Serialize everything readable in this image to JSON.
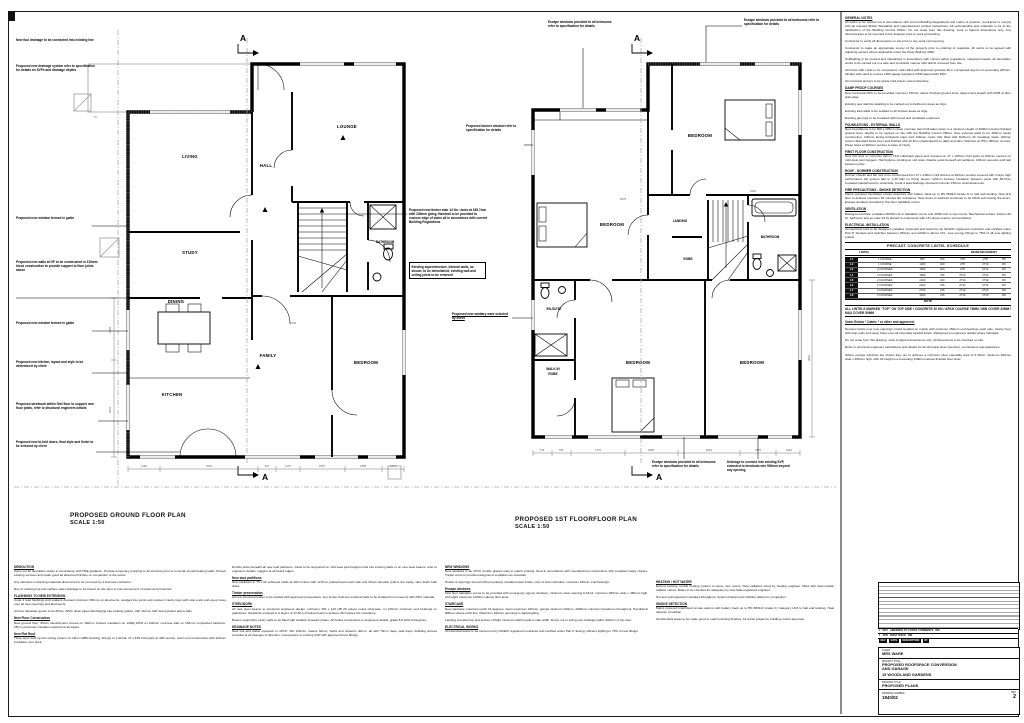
{
  "ground_plan": {
    "title": "PROPOSED GROUND FLOOR PLAN",
    "scale": "SCALE 1:50",
    "section_letter": "A",
    "grid_label": "B1",
    "rooms": {
      "living": "LIVING",
      "hall": "HALL",
      "lounge": "LOUNGE",
      "study": "STUDY",
      "bathroom": "BATHROOM",
      "dining": "DINING",
      "family": "FAMILY",
      "kitchen": "KITCHEN",
      "bedroom": "BEDROOM"
    },
    "dims_bottom": [
      "1190",
      "7016",
      "917",
      "1170",
      "1875",
      "1485",
      "1774"
    ],
    "dims_left": [
      "1884",
      "3001"
    ],
    "dims_inner": [
      "6703"
    ]
  },
  "first_plan": {
    "title": "PROPOSED 1ST FLOORFLOOR PLAN",
    "scale": "SCALE 1:50",
    "section_letter": "A",
    "rooms": {
      "bedroom1": "BEDROOM",
      "bedroom2": "BEDROOM",
      "landing": "LANDING",
      "robe": "ROBE",
      "bathroom": "BATHROOM",
      "ensuite": "EN-SUITE",
      "walkin1": "WALK IN",
      "walkin2": "ROBE",
      "bedroom3": "BEDROOM",
      "bedroom4": "BEDROOM"
    },
    "dims_bottom": [
      "719",
      "700",
      "1776",
      "1868",
      "5661",
      "1875",
      "2161"
    ],
    "dims_right": [
      "3601"
    ],
    "dims_inner": [
      "6275",
      "5420"
    ]
  },
  "callouts": {
    "left": [
      {
        "text": "New foul drainage to be connected into existing line"
      },
      {
        "text": "Proposed new drainage system refer to specification for details on SVPs and drainage depths"
      },
      {
        "text": "Proposed new window formed in gable"
      },
      {
        "text": "Proposed new walls at GF to be constructed in 215mm block construction to provide support to floor joists above"
      },
      {
        "text": "Proposed new window formed in gable"
      },
      {
        "text": "Proposed new kitchen, layout and style to be determined by client"
      },
      {
        "text": "Proposed steelwork within first floor to support new floor joists, refer to structural engineers details"
      },
      {
        "text": "Proposed new bi-fold doors, final style and finish to be selected by client"
      }
    ],
    "middle": [
      {
        "text": "Proposed new timber stair 14 No. risers at 185.7mm with 245mm going. Handrail to be provided to enclose edge of stairs all in accordance with current Building Regulations"
      },
      {
        "text": "Existing superstructure, internal walls, as shown, to be demolished, existing wall and ceiling joists to be removed"
      },
      {
        "text": "Proposed new sanitary ware selected by client"
      }
    ],
    "first": [
      {
        "text": "Escape windows provided to all bedrooms refer to specification for details"
      },
      {
        "text": "Escape windows provided to all bedrooms refer to specification for details"
      },
      {
        "text": "Proposed dormer window refer to specification for details"
      },
      {
        "text": "Escape windows provided to all bedrooms refer to specification for details"
      },
      {
        "text": "Drainage to connect into existing SVP, extended to terminate min 900mm beyond any opening"
      }
    ]
  },
  "notes_right": {
    "blocks": [
      {
        "head": "GENERAL NOTES",
        "text": "All works to be carried out in accordance with current Building Regulations and codes of practice. Contractor to comply with all relevant British Standards and manufacturers printed instructions. All workmanship and materials to be to the satisfaction of the Building Control Officer. Do not scale from this drawing, work to figured dimensions only. Any discrepancies to be reported to the designer prior to work proceeding."
      },
      {
        "head": "",
        "text": "Contractor to verify all dimensions on site prior to any work commencing."
      },
      {
        "head": "",
        "text": "Contractor to make an appropriate survey of the property prior to ordering of materials. All works to be agreed with adjoining owners where applicable under the Party Wall Act 1996."
      },
      {
        "head": "",
        "text": "Scaffolding to be erected and maintained in accordance with current safety regulations, inspected weekly. All demolition works to be carried out in a safe and controlled manner with debris removed from site."
      },
      {
        "head": "",
        "text": "All below slab voids to be compacted, voids filled with approved granular fill in compacted layers not exceeding 225mm, blinded with sand to receive 1200 gauge polythene DPM lapped with DPC."
      },
      {
        "head": "",
        "text": "All structural timbers to be grade C24 unless noted otherwise."
      },
      {
        "head": "DAMP PROOF COURSES",
        "text": "New horizontal DPC to be provided minimum 150mm above finished ground level, lapped and sealed with DPM at floor slab edge."
      },
      {
        "head": "",
        "text": "Existing new wall tile detailing to be carried out to bathroom areas as drgs."
      },
      {
        "head": "",
        "text": "Existing tiled walls to be isolated to all shower areas as drgs."
      },
      {
        "head": "",
        "text": "Existing gas pipe to be insulated with boxed and ventilated enclosure."
      },
      {
        "head": "FOUNDATIONS - EXTERNAL WALLS",
        "text": "New foundations to be 600 x 225mm deep concrete trench fill taken down to a minimum depth of 1000mm below finished ground level, depths to be agreed on site with the Building Control Officer. New external walls to be 300mm cavity construction; 100mm facing brickwork outer leaf, 100mm cavity fully filled with Dritherm 32 insulation batts, 100mm Celcon Standard block inner leaf finished with 12.5mm plasterboard on dabs and skim. Wall ties at 750 x 450mm centres. Weep holes at 900mm centres to base of cavity."
      },
      {
        "head": "FIRST FLOOR CONSTRUCTION",
        "text": "New first floor to comprise 22mm T&G chipboard glued and screwed on 47 x 195mm C24 joists at 400mm centres on mild steel joist hangers. Herringbone strutting at mid span. Double joists beneath all partitions. 100mm acoustic quilt laid between joists."
      },
      {
        "head": "ROOF - DORMER CONSTRUCTION",
        "text": "Dormer cheeks and flat roof to be constructed from 47 x 145mm C24 timbers at 400mm centres covered with 3 layer high performance felt system laid to 1:40 falls on firring pieces. 120mm Celotex insulation between joists with 52.5mm insulated plasterboard to underside. Code 4 lead flashings dressed minimum 150mm at all abutments."
      },
      {
        "head": "FIRE PRECAUTIONS - SMOKE DETECTION",
        "text": "Mains operated interlinked smoke detectors with battery back up to BS 5839-6 Grade D to hall and landing. New first floor to achieve minimum 30 minutes fire resistance. New doors to stairwell enclosure to be FD20 self closing fire doors. Escape windows provided to first floor habitable rooms."
      },
      {
        "head": "VENTILATION",
        "text": "Background trickle ventilation 8000mm2 to habitable rooms and 4000mm2 to wet rooms. Mechanical extract: kitchen 60 l/s, bathroom and en-suite 15 l/s ducted to external air with 15 minute overrun via humidistat."
      },
      {
        "head": "ELECTRICAL INSTALLATION",
        "text": "All electrical work to be designed, installed, inspected and tested by an NICEIC registered contractor and certified under Part P. Sockets and switches between 450mm and 1200mm above FFL. Low energy fittings to 75% of all new lighting outlets."
      }
    ]
  },
  "lintel_schedule": {
    "title": "PRECAST CONCRETE LINTEL SCHEDULE",
    "group_left": "LINTEL",
    "group_right": "REINFORCEMENT",
    "columns": [
      "REF",
      "DEPTH IN BRICK COURSES",
      "LENGTH",
      "WIDTH",
      "TOP",
      "BTM",
      "LINKS"
    ],
    "rows": [
      [
        "L1",
        "1 COURSE",
        "900",
        "100",
        "2T8",
        "2T8",
        "R6"
      ],
      [
        "L2",
        "1 COURSE",
        "1200",
        "100",
        "2T8",
        "2T10",
        "R6"
      ],
      [
        "L3",
        "2 COURSES",
        "1500",
        "100",
        "2T8",
        "2T10",
        "R6"
      ],
      [
        "L4",
        "2 COURSES",
        "1800",
        "215",
        "2T10",
        "2T12",
        "R6"
      ],
      [
        "L5",
        "2 COURSES",
        "2100",
        "100",
        "2T10",
        "2T12",
        "R6"
      ],
      [
        "L6",
        "3 COURSES",
        "2400",
        "215",
        "2T12",
        "2T16",
        "R8"
      ],
      [
        "L7",
        "3 COURSES",
        "2700",
        "215",
        "2T12",
        "2T16",
        "R8"
      ],
      [
        "L8",
        "3 COURSES",
        "3000",
        "215",
        "2T16",
        "2T20",
        "R8"
      ]
    ],
    "note_label": "NOTE",
    "footer": "ALL LINTELS MARKED \"TOP\" ON TOP SIDE / CONCRETE 30 KN / ARCH COURSE 75MM / MIN COVER 20MM / MAX COVER 50MM"
  },
  "post_table": {
    "blocks": [
      {
        "head": "Outer Bricks * Catnic * or other and approved.",
        "text": ""
      },
      {
        "head": "",
        "text": "Denotes lintels over new openings; lintels bedded on mortar with minimum 150mm end bearings each side. Cavity trays with stop ends and weep holes over all externally located lintels. Padstones to engineers details where indicated."
      },
      {
        "head": "",
        "text": "Do not scale from this drawing, work to figured dimensions only; all dimensions to be checked on site."
      },
      {
        "head": "",
        "text": "Refer to structural engineers calculations and details for all structural steel members, connections and padstones."
      },
      {
        "head": "",
        "text": "Where escape windows are shown they are to achieve a minimum clear openable area of 0.33m2, minimum 450mm wide x 450mm high, with cill height not exceeding 1100mm above finished floor level."
      }
    ]
  },
  "bottom_notes": {
    "col1": {
      "blocks": [
        {
          "head": "DEMOLITION",
          "text": "Carry out all demolition works in accordance with HSE guidance. Provide temporary propping to all structure prior to removal of load bearing walls. Protect existing services and make good all disturbed finishes on completion of the works."
        },
        {
          "head": "",
          "text": "Any asbestos containing materials discovered to be removed by a licensed contractor."
        },
        {
          "head": "",
          "text": "Run of existing foul and surface water drainage to be traced on site prior to commencement of works and protected."
        },
        {
          "head": "FLASHINGS TO NEW EXTENSION",
          "text": "Code 4 lead flashings and soakers dressed minimum 150mm up abutments, wedged into joints and pointed. Cavity trays with stop ends and weep holes over all new openings and abutments."
        },
        {
          "head": "",
          "text": "All new rainwater goods to be 68mm uPVC down pipes discharging into existing gullies, with 112mm half round gutters laid to falls."
        },
        {
          "head": "New Floor Construction",
          "text": "New ground floor: 65mm sand/cement screed on 100mm Celotex insulation on 1200g DPM on 100mm concrete slab on 150mm compacted hardcore. 25mm perimeter insulation upstand at all edges."
        },
        {
          "head": "New Flat Roof",
          "text": "Three layer built up felt roofing system on 18mm WBP decking, firrings to 1:40 fall, 47 x 195 C24 joists at 400 centres, warm roof construction with 120mm insulation over deck."
        }
      ]
    },
    "col2": {
      "blocks": [
        {
          "head": "",
          "text": "Double joists beneath all new stud partitions. Joists to be supported on mild steel joist hangers built into existing walls or on new steel beams, refer to engineers details, noggins at all board edges."
        },
        {
          "head": "New stud partitions",
          "text": "New partitions in 75 x 50 softwood studs at 400 centres with 12.5mm plasterboard each side and 25mm acoustic quilt in the cavity, skim finish both sides."
        },
        {
          "head": "Timber preservation",
          "text": "All new structural timber to be treated with approved preservative. Any timber built into external walls to be isolated from masonry with DPC material."
        },
        {
          "head": "STEELWORK",
          "text": "All new steel beams to structural engineers design, minimum 203 x 133 UB 25 unless noted otherwise, on 100mm minimum end bearings on padstones. Steelwork encased in 2 layers of 12.5mm Fireline board to achieve 30 minutes fire resistance."
        },
        {
          "head": "",
          "text": "Beams supporting cavity walls to be fitted with suitable spreader plates. All bolted connections to engineers details, grade 8.8 bolts throughout."
        },
        {
          "head": "DRAINAGE NOTES",
          "text": "New soil and waste pipework in uPVC: WC 100mm, basins 32mm, baths and showers 40mm, all with 75mm deep seal traps. Rodding access provided at all changes of direction. Connections to existing SVP with approved boss fittings."
        }
      ]
    },
    "col3": {
      "blocks": [
        {
          "head": "NEW WINDOWS",
          "text": "New windows to be uPVC double glazed units to match existing, fixed in accordance with manufacturers instructions with insulated cavity closers. Trickle vents to provide background ventilation as schedule."
        },
        {
          "head": "",
          "text": "Heads of openings formed with proprietary insulated steel lintels, refer to lintel schedule, minimum 150mm end bearings."
        },
        {
          "head": "Escape windows",
          "text": "First floor habitable rooms to be provided with emergency egress windows, minimum clear opening 0.33m2, minimum 450mm wide x 450mm high, cill height maximum 1100mm above floor level."
        },
        {
          "head": "STAIRCASE",
          "text": "New staircase: maximum pitch 42 degrees, risers maximum 220mm, goings minimum 220mm, 2000mm minimum headroom throughout. Handrail at 900mm above pitch line. Maximum 100mm openings to balustrading."
        },
        {
          "head": "",
          "text": "Landing provided top and bottom of flight minimum width equal to stair width. Doors not to swing over landings within 400mm of top riser."
        },
        {
          "head": "ELECTRICAL WORKS",
          "text": "All electrical works to be carried out by NICEIC registered contractor and certified under Part P. Energy efficient lighting to 75% of new fittings."
        }
      ]
    },
    "col4": {
      "blocks": [
        {
          "head": "HEATING / HOT WATER",
          "text": "Extend existing central heating system to serve new rooms. New radiators sized by heating engineer, fitted with thermostatic radiator valves. Boiler to be checked for adequacy by Gas Safe registered engineer."
        },
        {
          "head": "",
          "text": "Hot and cold pipework insulated throughout. System flushed and inhibitor added on completion."
        },
        {
          "head": "SMOKE DETECTION",
          "text": "Mains powered interlinked smoke alarms with battery back up to BS 5839-6 Grade D, Category LD3 to hall and landing. Heat detector to kitchen."
        },
        {
          "head": "",
          "text": "All disturbed areas to be made good to match existing finishes. All works subject to building control approval."
        }
      ]
    }
  },
  "revision_table": {
    "header": [
      "REV",
      "DATE",
      "DESCRIPTION",
      "BY"
    ],
    "entries": [
      {
        "rev": "2",
        "date": "MAY",
        "desc": "AMENDED TO CLIENT COMMENTS",
        "by": "RW"
      },
      {
        "rev": "1",
        "date": "APR",
        "desc": "FIRST ISSUE",
        "by": "RW"
      }
    ]
  },
  "title_block": {
    "client_label": "CLIENT",
    "client": "MRS WARE",
    "project_label": "PROJECT TITLE",
    "project_line1": "PROPOSED ROOFSPACE CONVERSION",
    "project_line2": "AND GARAGE",
    "project_line3": "15 WOODLAND GARDENS",
    "drawing_label": "DRAWING TITLE",
    "drawing": "PROPOSED PLANS",
    "number_label": "DRAWING NUMBER",
    "number": "1840/02",
    "rev_label": "REV",
    "rev": "2"
  }
}
